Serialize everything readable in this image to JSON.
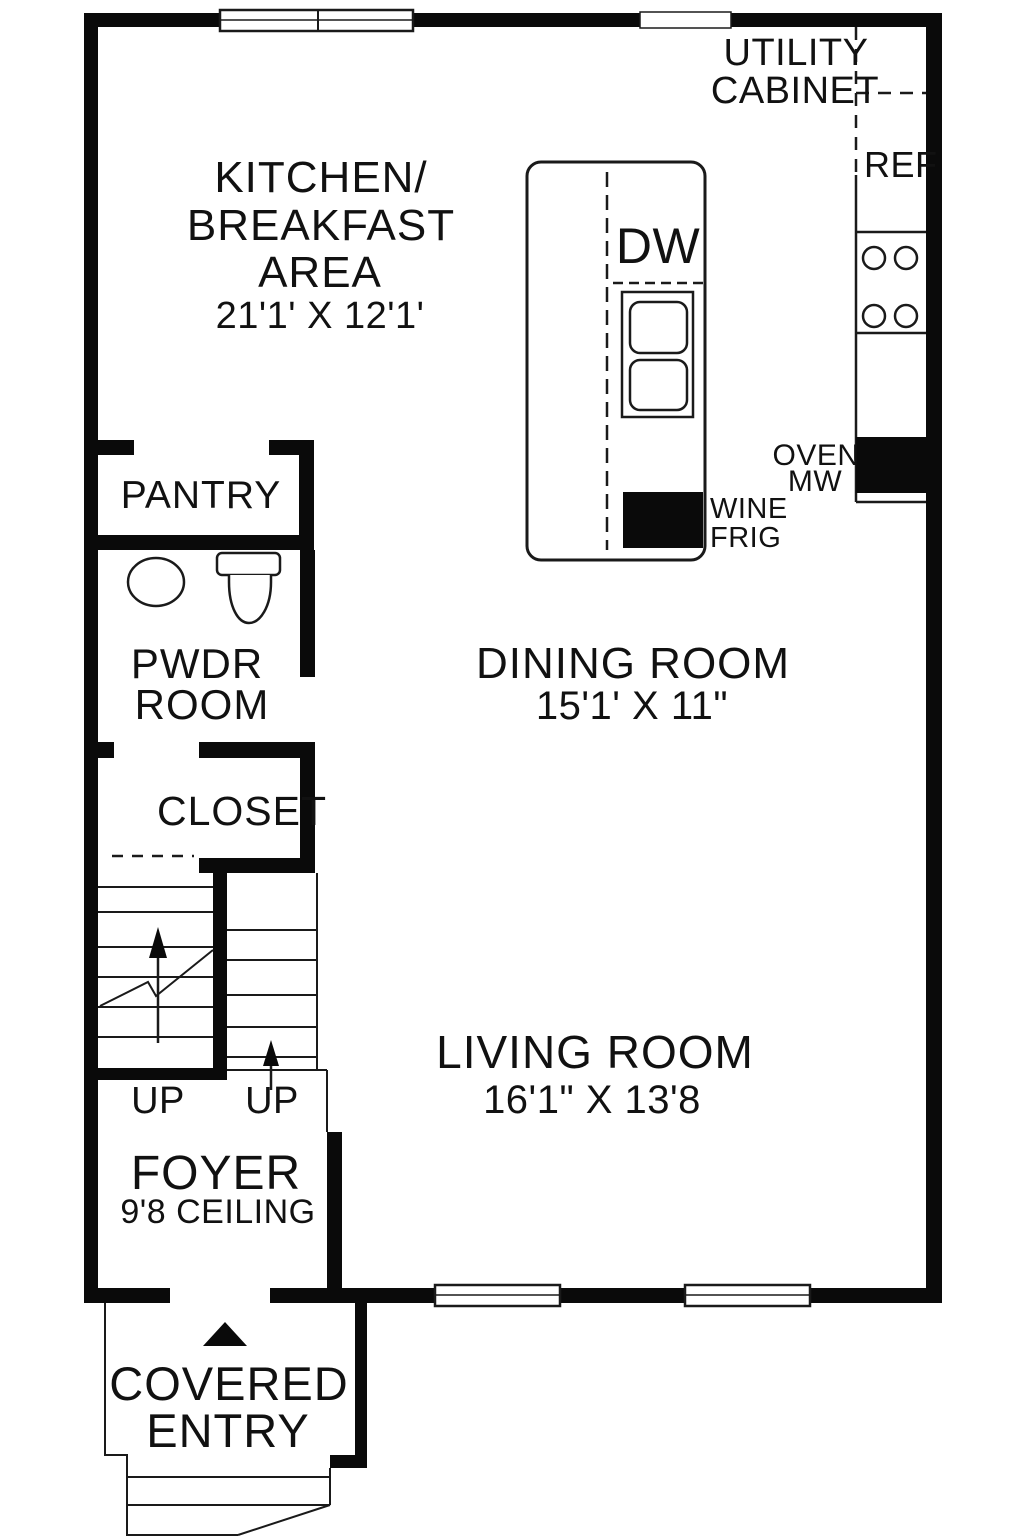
{
  "plan": {
    "title": "First floor plan",
    "colors": {
      "wall": "#0a0a0a",
      "background": "#ffffff",
      "line": "#1a1a1a"
    },
    "rooms": {
      "kitchen": {
        "name_line1": "KITCHEN/",
        "name_line2": "BREAKFAST",
        "name_line3": "AREA",
        "dimensions": "21'1' X 12'1'"
      },
      "dining": {
        "name": "DINING ROOM",
        "dimensions": "15'1' X 11\""
      },
      "living": {
        "name": "LIVING ROOM",
        "dimensions": "16'1\" X 13'8"
      },
      "pantry": {
        "name": "PANTRY"
      },
      "powder": {
        "name_line1": "PWDR",
        "name_line2": "ROOM"
      },
      "closet": {
        "name": "CLOSET"
      },
      "foyer": {
        "name": "FOYER",
        "ceiling": "9'8 CEILING"
      },
      "entry": {
        "name_line1": "COVERED",
        "name_line2": "ENTRY"
      }
    },
    "fixtures": {
      "utility_cabinet_line1": "UTILITY",
      "utility_cabinet_line2": "CABINET",
      "refrigerator": "REF",
      "dishwasher": "DW",
      "wine_frig_line1": "WINE",
      "wine_frig_line2": "FRIG",
      "oven": "OVEN",
      "microwave": "MW",
      "stairs_up_left": "UP",
      "stairs_up_right": "UP"
    }
  }
}
